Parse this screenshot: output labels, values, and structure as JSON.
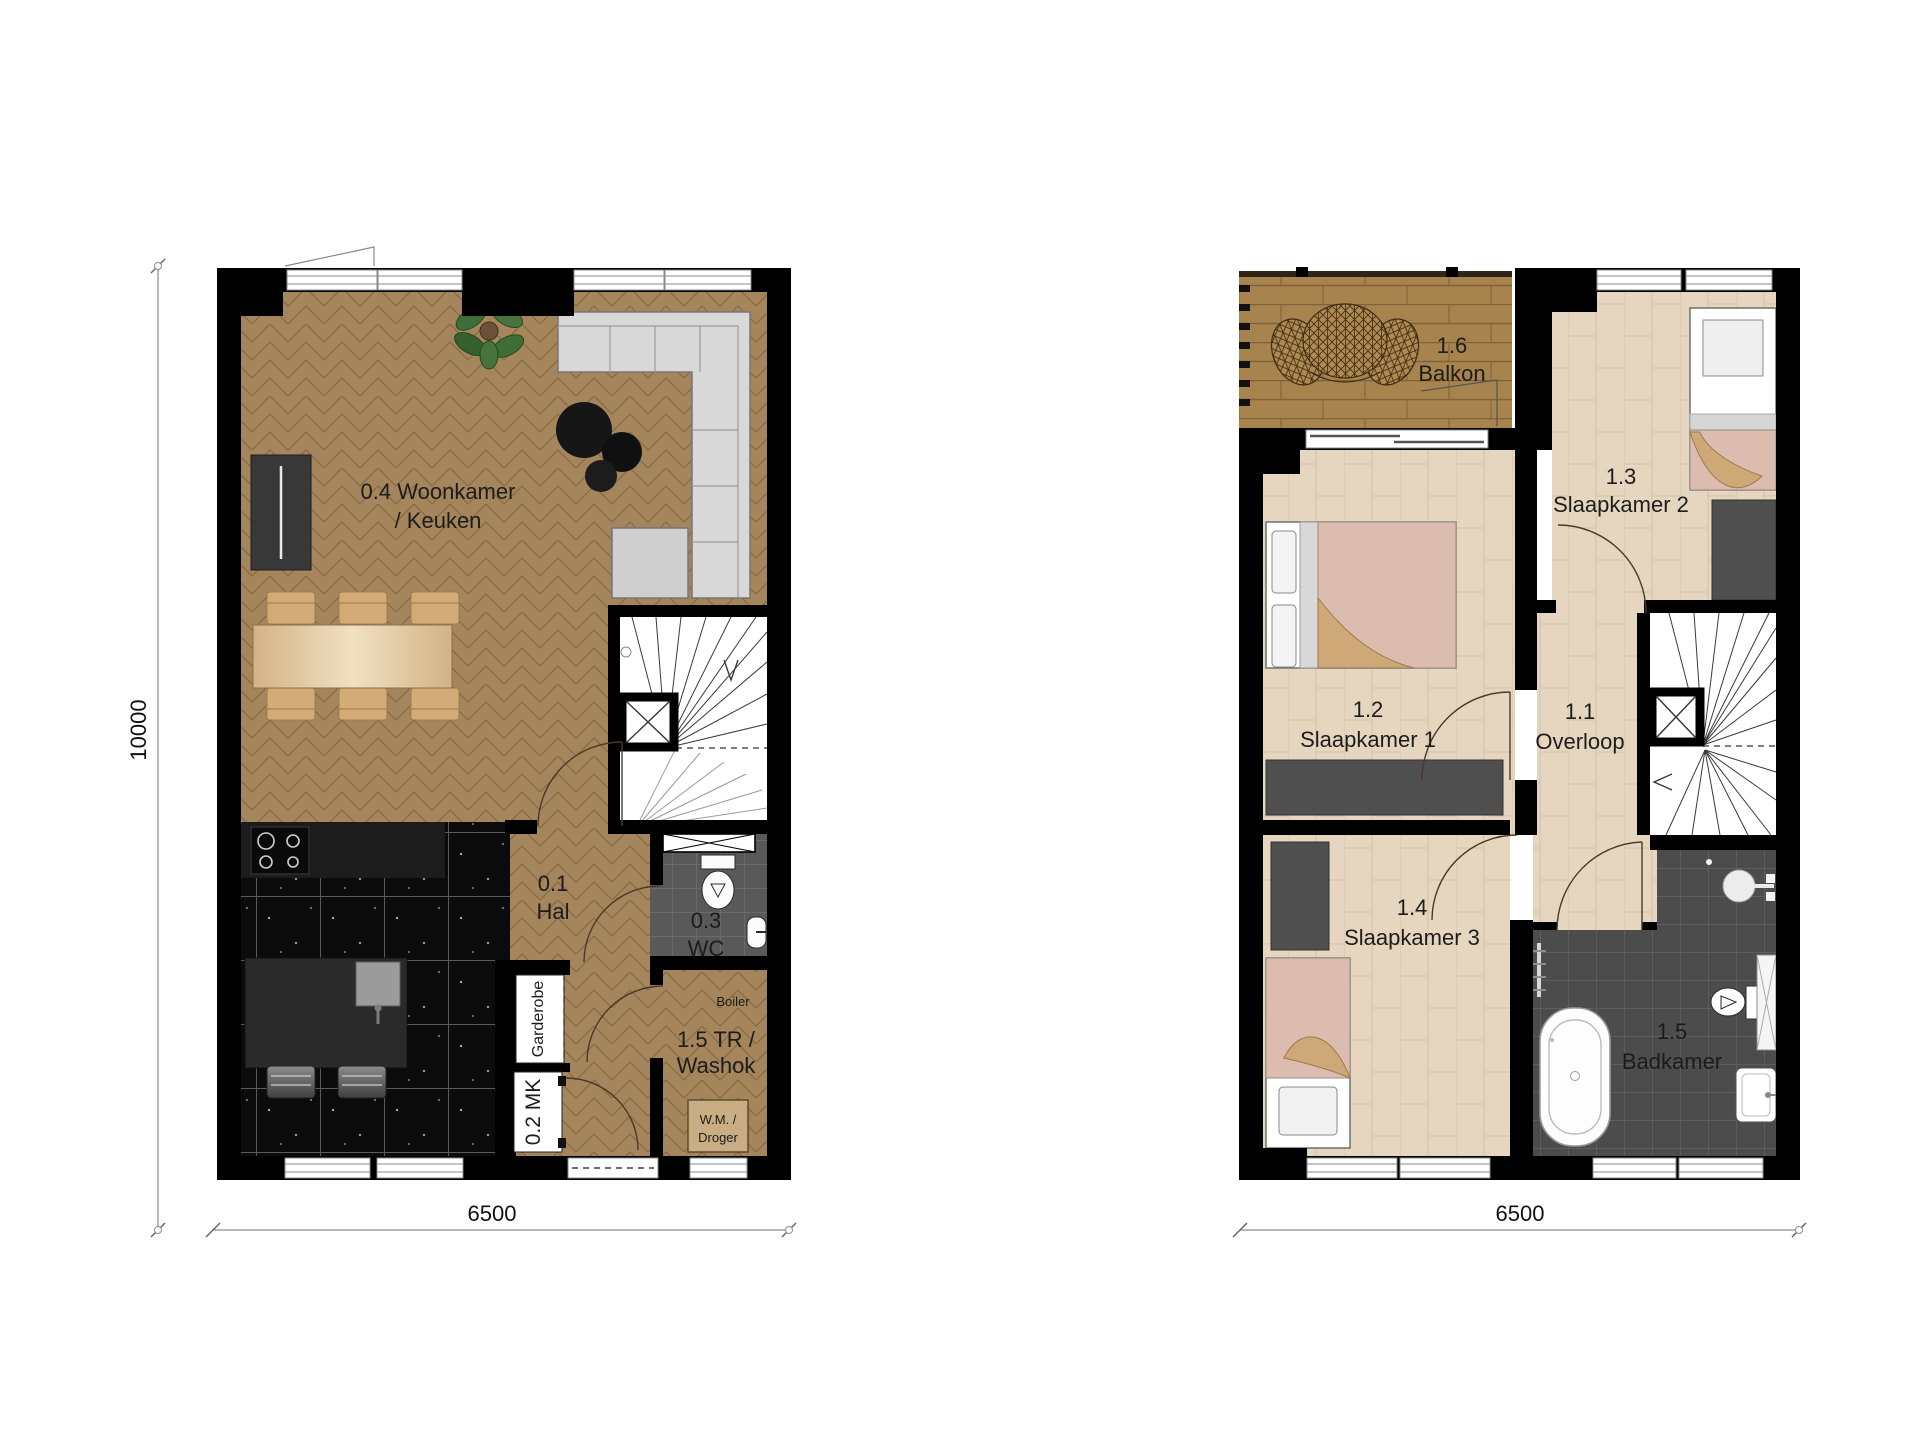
{
  "ground_floor": {
    "living": {
      "line1": "0.4 Woonkamer",
      "line2": "/ Keuken"
    },
    "hal": {
      "line1": "0.1",
      "line2": "Hal"
    },
    "wc": {
      "line1": "0.3",
      "line2": "WC"
    },
    "meterkast": {
      "label": "0.2 MK"
    },
    "garderobe": {
      "label": "Garderobe"
    },
    "washok": {
      "line1": "1.5 TR /",
      "line2": "Washok"
    },
    "boiler": {
      "label": "Boiler"
    },
    "wasmachine": {
      "line1": "W.M. /",
      "line2": "Droger"
    }
  },
  "first_floor": {
    "balkon": {
      "line1": "1.6",
      "line2": "Balkon"
    },
    "slaapkamer2": {
      "line1": "1.3",
      "line2": "Slaapkamer 2"
    },
    "slaapkamer1": {
      "line1": "1.2",
      "line2": "Slaapkamer 1"
    },
    "overloop": {
      "line1": "1.1",
      "line2": "Overloop"
    },
    "slaapkamer3": {
      "line1": "1.4",
      "line2": "Slaapkamer 3"
    },
    "badkamer": {
      "line1": "1.5",
      "line2": "Badkamer"
    }
  },
  "dimensions": {
    "height_left": "10000",
    "width_left": "6500",
    "width_right": "6500"
  },
  "colors": {
    "wall": "#000000",
    "wood_floor": "#a5855c",
    "plank_floor": "#e6d6bf",
    "deck_floor": "#a7834e",
    "kitchen_floor": "#0b0b0b",
    "bathroom_floor": "#4c4c4c",
    "wc_floor": "#595959",
    "wardrobe": "#4f4f4f",
    "bed_blanket": "#ddbcb0",
    "bed_fold": "#cfa878",
    "sofa": "#d8d8d8"
  }
}
